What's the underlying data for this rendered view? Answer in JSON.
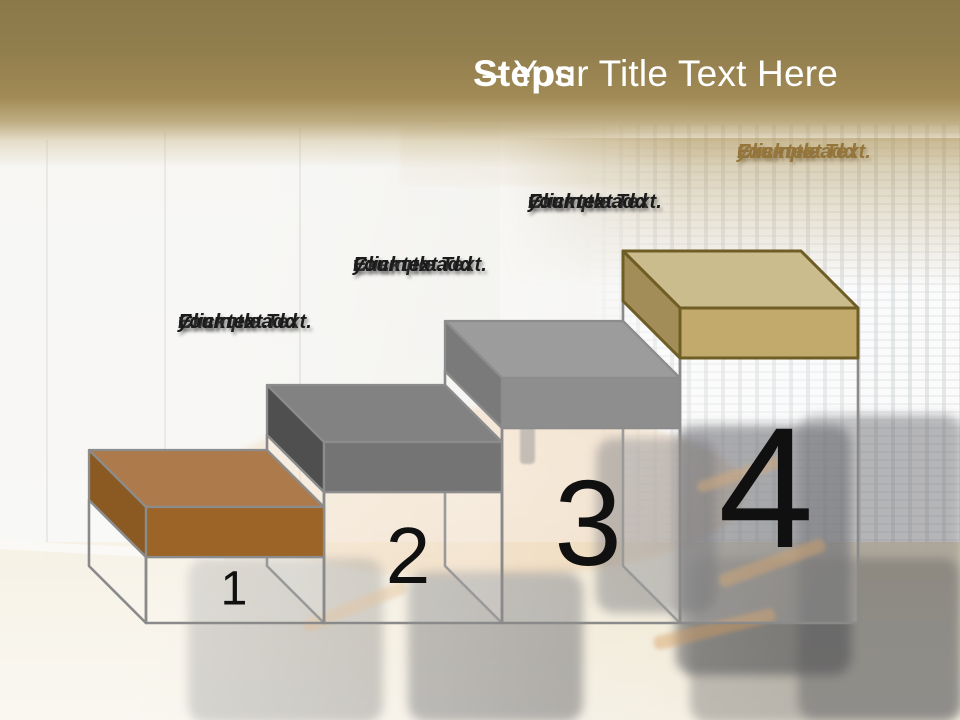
{
  "slide_title": {
    "bold": "Steps",
    "rest": "– Your Title Text Here"
  },
  "theme": {
    "header_gold_dark": "#8d7a4a",
    "header_gold_light": "#a8915a",
    "title_color": "#ffffff",
    "wireframe_stroke": "#8a8a8a",
    "number_color": "#111111",
    "label_color": "#1b1b1b",
    "step4_label_color": "#96763a"
  },
  "steps": [
    {
      "number": "1",
      "label_lines": [
        "Example Text.",
        "Click  to add",
        "your text."
      ],
      "colors": {
        "top": "#ad7b4b",
        "front": "#9c6426",
        "side": "#8a5a22",
        "border": "#8c8c8c"
      }
    },
    {
      "number": "2",
      "label_lines": [
        "Example Text.",
        "Click  to add",
        "your text."
      ],
      "colors": {
        "top": "#828282",
        "front": "#747474",
        "side": "#4f4f4f",
        "border": "#8c8c8c"
      }
    },
    {
      "number": "3",
      "label_lines": [
        "Example Text.",
        "Click  to add",
        "your text."
      ],
      "colors": {
        "top": "#9c9c9c",
        "front": "#8e8e8e",
        "side": "#7a7a7a",
        "border": "#8c8c8c"
      }
    },
    {
      "number": "4",
      "label_lines": [
        "Example Text.",
        "Click  to add",
        "your text."
      ],
      "colors": {
        "top": "#cbbc8e",
        "front": "#c1aa6c",
        "side": "#a28d58",
        "border": "#6e5e25"
      }
    }
  ]
}
